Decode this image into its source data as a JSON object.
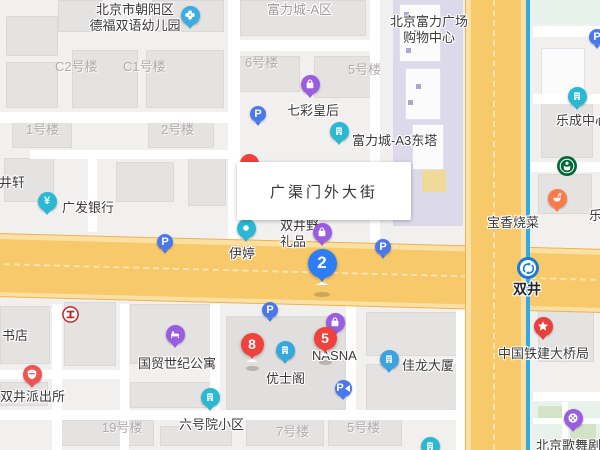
{
  "street_box": {
    "text": "广渠门外大街"
  },
  "colors": {
    "road_fill": "#F8C96B",
    "road_shoulder": "#FAE0A3",
    "road_edge": "#EDB158",
    "metro_line": "#2FA9E7",
    "metro_ring": "#1B7BD3",
    "block": "#F1F0EF",
    "building": "#E4E3E2",
    "mall_area": "#DCD9EB",
    "green_area": "#E8F2EC",
    "pin_selected_blue": "#2E7CF6",
    "pin_number_red": "#F0413D",
    "pin_teal": "#29B9D3",
    "pin_blue": "#3BA3E2",
    "pin_lightblue": "#3BAEE0",
    "pin_purple": "#9A5CE0",
    "pin_orange": "#FA7A48",
    "pin_police_red": "#F05352",
    "pin_star_red": "#E8413C",
    "parking_blue": "#4A78EC",
    "starbucks_green": "#056937",
    "icbc_red": "#C5242A"
  },
  "building_labels": [
    {
      "text": "C2号楼",
      "x": 55,
      "y": 59
    },
    {
      "text": "C1号楼",
      "x": 123,
      "y": 59
    },
    {
      "text": "6号楼",
      "x": 245,
      "y": 55
    },
    {
      "text": "5号楼",
      "x": 348,
      "y": 62
    },
    {
      "text": "1号楼",
      "x": 26,
      "y": 122
    },
    {
      "text": "2号楼",
      "x": 161,
      "y": 122
    },
    {
      "text": "19号楼",
      "x": 102,
      "y": 420
    },
    {
      "text": "7号楼",
      "x": 276,
      "y": 424
    },
    {
      "text": "5号楼",
      "x": 347,
      "y": 420
    }
  ],
  "pois": [
    {
      "name": "kindergarten",
      "lines": [
        "北京市朝阳区",
        "德福双语幼儿园"
      ],
      "lx": 85,
      "ly": 2,
      "style": "center",
      "w": 100,
      "marker": {
        "kind": "cat",
        "icon": "flower-icon",
        "color": "#3BAEE0",
        "x": 190,
        "y": 15
      }
    },
    {
      "name": "area-fulicheng-a",
      "lines": [
        "富力城-A区"
      ],
      "lx": 267,
      "ly": 2,
      "style": "graylg"
    },
    {
      "name": "qicai-huanghou",
      "lines": [
        "七彩皇后"
      ],
      "lx": 287,
      "ly": 103,
      "style": "dark",
      "marker": {
        "kind": "cat",
        "icon": "bag-icon",
        "color": "#9A5CE0",
        "x": 310,
        "y": 84
      }
    },
    {
      "name": "parking-north-1",
      "marker": {
        "kind": "p",
        "icon": "parking-icon",
        "x": 258,
        "y": 114
      }
    },
    {
      "name": "fulicheng-a3-east-tower",
      "lines": [
        "富力城-A3东塔"
      ],
      "lx": 352,
      "ly": 133,
      "style": "dark",
      "marker": {
        "kind": "cat",
        "icon": "building-icon",
        "color": "#29B9D3",
        "x": 339,
        "y": 131
      }
    },
    {
      "name": "fuli-plaza-mall",
      "lines": [
        "北京富力广场",
        "购物中心"
      ],
      "lx": 383,
      "ly": 14,
      "style": "center",
      "w": 92
    },
    {
      "name": "shuangjingxuan",
      "lines": [
        "双井轩"
      ],
      "lx": -14,
      "ly": 175,
      "style": "dark"
    },
    {
      "name": "guangfa-bank",
      "lines": [
        "广发银行"
      ],
      "lx": 62,
      "ly": 200,
      "style": "dark",
      "marker": {
        "kind": "cat",
        "icon": "yuan-icon",
        "color": "#29B9D3",
        "x": 47,
        "y": 201
      }
    },
    {
      "name": "parking-west",
      "marker": {
        "kind": "p",
        "icon": "parking-icon",
        "x": 165,
        "y": 242
      }
    },
    {
      "name": "yiting",
      "lines": [
        "伊婷"
      ],
      "lx": 229,
      "ly": 246,
      "style": "dark",
      "marker": {
        "kind": "cat",
        "icon": "dot-icon",
        "color": "#29B9D3",
        "x": 246,
        "y": 228
      }
    },
    {
      "name": "gift-shop",
      "lines": [
        "双井野",
        "礼品"
      ],
      "lx": 280,
      "ly": 218,
      "style": "dark"
    },
    {
      "name": "bag-shop-north",
      "marker": {
        "kind": "cat",
        "icon": "bag-icon",
        "color": "#9A5CE0",
        "x": 322,
        "y": 232
      }
    },
    {
      "name": "selected-result-2",
      "marker": {
        "kind": "num",
        "value": "2",
        "color": "#2E7CF6",
        "size": "big",
        "x": 322,
        "y": 263,
        "shadow_y": 292
      }
    },
    {
      "name": "parking-road-north",
      "marker": {
        "kind": "p",
        "icon": "parking-icon",
        "x": 383,
        "y": 247
      }
    },
    {
      "name": "baoxiang-restaurant",
      "lines": [
        "宝香烧菜"
      ],
      "lx": 487,
      "ly": 215,
      "style": "dark",
      "marker": {
        "kind": "cat",
        "icon": "bowl-icon",
        "color": "#FA7A48",
        "x": 557,
        "y": 198
      }
    },
    {
      "name": "lecheng-center",
      "lines": [
        "乐成中心"
      ],
      "lx": 556,
      "ly": 113,
      "style": "dark",
      "marker": {
        "kind": "cat",
        "icon": "building-icon",
        "color": "#29B9D3",
        "x": 577,
        "y": 96
      }
    },
    {
      "name": "starbucks",
      "marker": {
        "kind": "starbucks",
        "icon": "starbucks-icon",
        "x": 567,
        "y": 166
      }
    },
    {
      "name": "le-partial-label",
      "lines": [
        "乐"
      ],
      "lx": 589,
      "ly": 208,
      "style": "dark"
    },
    {
      "name": "shuangjing-metro-station",
      "lines": [
        "双井"
      ],
      "lx": 513,
      "ly": 281,
      "style": "bold",
      "marker": {
        "kind": "station",
        "icon": "metro-icon",
        "x": 528,
        "y": 268
      }
    },
    {
      "name": "parking-east-edge",
      "marker": {
        "kind": "p",
        "icon": "parking-icon",
        "x": 597,
        "y": 37
      }
    },
    {
      "name": "bookstore",
      "lines": [
        "书店"
      ],
      "lx": 2,
      "ly": 328,
      "style": "dark"
    },
    {
      "name": "icbc-bank",
      "marker": {
        "kind": "icbc",
        "icon": "icbc-icon",
        "x": 70,
        "y": 314
      }
    },
    {
      "name": "guomao-century-apartment",
      "lines": [
        "国贸世纪公寓"
      ],
      "lx": 138,
      "ly": 356,
      "style": "dark",
      "marker": {
        "kind": "cat",
        "icon": "bed-icon",
        "color": "#9A5CE0",
        "x": 175,
        "y": 334
      }
    },
    {
      "name": "shuangjing-police-station",
      "lines": [
        "双井派出所"
      ],
      "lx": 0,
      "ly": 389,
      "style": "dark",
      "marker": {
        "kind": "cat",
        "icon": "badge-icon",
        "color": "#F05352",
        "x": 32,
        "y": 374
      }
    },
    {
      "name": "liuhaoyuan-community",
      "lines": [
        "六号院小区"
      ],
      "lx": 179,
      "ly": 417,
      "style": "dark",
      "marker": {
        "kind": "cat",
        "icon": "building-icon",
        "color": "#29B9D3",
        "x": 210,
        "y": 397
      }
    },
    {
      "name": "youshige",
      "lines": [
        "优士阁"
      ],
      "lx": 266,
      "ly": 371,
      "style": "dark",
      "marker": {
        "kind": "cat",
        "icon": "building-icon",
        "color": "#35A9DD",
        "x": 285,
        "y": 350
      }
    },
    {
      "name": "result-marker-8",
      "marker": {
        "kind": "num",
        "value": "8",
        "color": "#F0413D",
        "size": "mid",
        "x": 252,
        "y": 344,
        "shadow_y": 366
      }
    },
    {
      "name": "result-marker-5",
      "marker": {
        "kind": "num",
        "value": "5",
        "color": "#F0413D",
        "size": "mid",
        "x": 325,
        "y": 338,
        "shadow_y": 360
      }
    },
    {
      "name": "nasna",
      "lines": [
        "NASNA"
      ],
      "lx": 312,
      "ly": 348,
      "style": "dark"
    },
    {
      "name": "bag-shop-south",
      "marker": {
        "kind": "cat",
        "icon": "bag-icon",
        "color": "#9A5CE0",
        "x": 335,
        "y": 322
      }
    },
    {
      "name": "parking-south",
      "marker": {
        "kind": "p",
        "icon": "parking-icon",
        "x": 270,
        "y": 310
      }
    },
    {
      "name": "parking-entrance",
      "marker": {
        "kind": "pent",
        "icon": "parking-entrance-icon",
        "x": 343,
        "y": 388
      }
    },
    {
      "name": "jialong-tower",
      "lines": [
        "佳龙大厦"
      ],
      "lx": 402,
      "ly": 358,
      "style": "dark",
      "marker": {
        "kind": "cat",
        "icon": "building-icon",
        "color": "#3BA3E2",
        "x": 389,
        "y": 359
      }
    },
    {
      "name": "china-railway-bridge-bureau",
      "lines": [
        "中国铁建大桥局"
      ],
      "lx": 498,
      "ly": 346,
      "style": "dark",
      "marker": {
        "kind": "cat",
        "icon": "star-icon",
        "color": "#E8413C",
        "x": 543,
        "y": 326
      }
    },
    {
      "name": "beijing-song-dance-theater",
      "lines": [
        "北京歌舞剧"
      ],
      "lx": 536,
      "ly": 438,
      "style": "dark",
      "marker": {
        "kind": "cat",
        "icon": "film-icon",
        "color": "#9A5CE0",
        "x": 573,
        "y": 418
      }
    },
    {
      "name": "edge-building-poi",
      "marker": {
        "kind": "cat",
        "icon": "building-icon",
        "color": "#29B9D3",
        "x": 430,
        "y": 446
      }
    },
    {
      "name": "occluded-red-marker",
      "marker": {
        "kind": "plain",
        "color": "#F0413D",
        "x": 249,
        "y": 163
      }
    }
  ]
}
